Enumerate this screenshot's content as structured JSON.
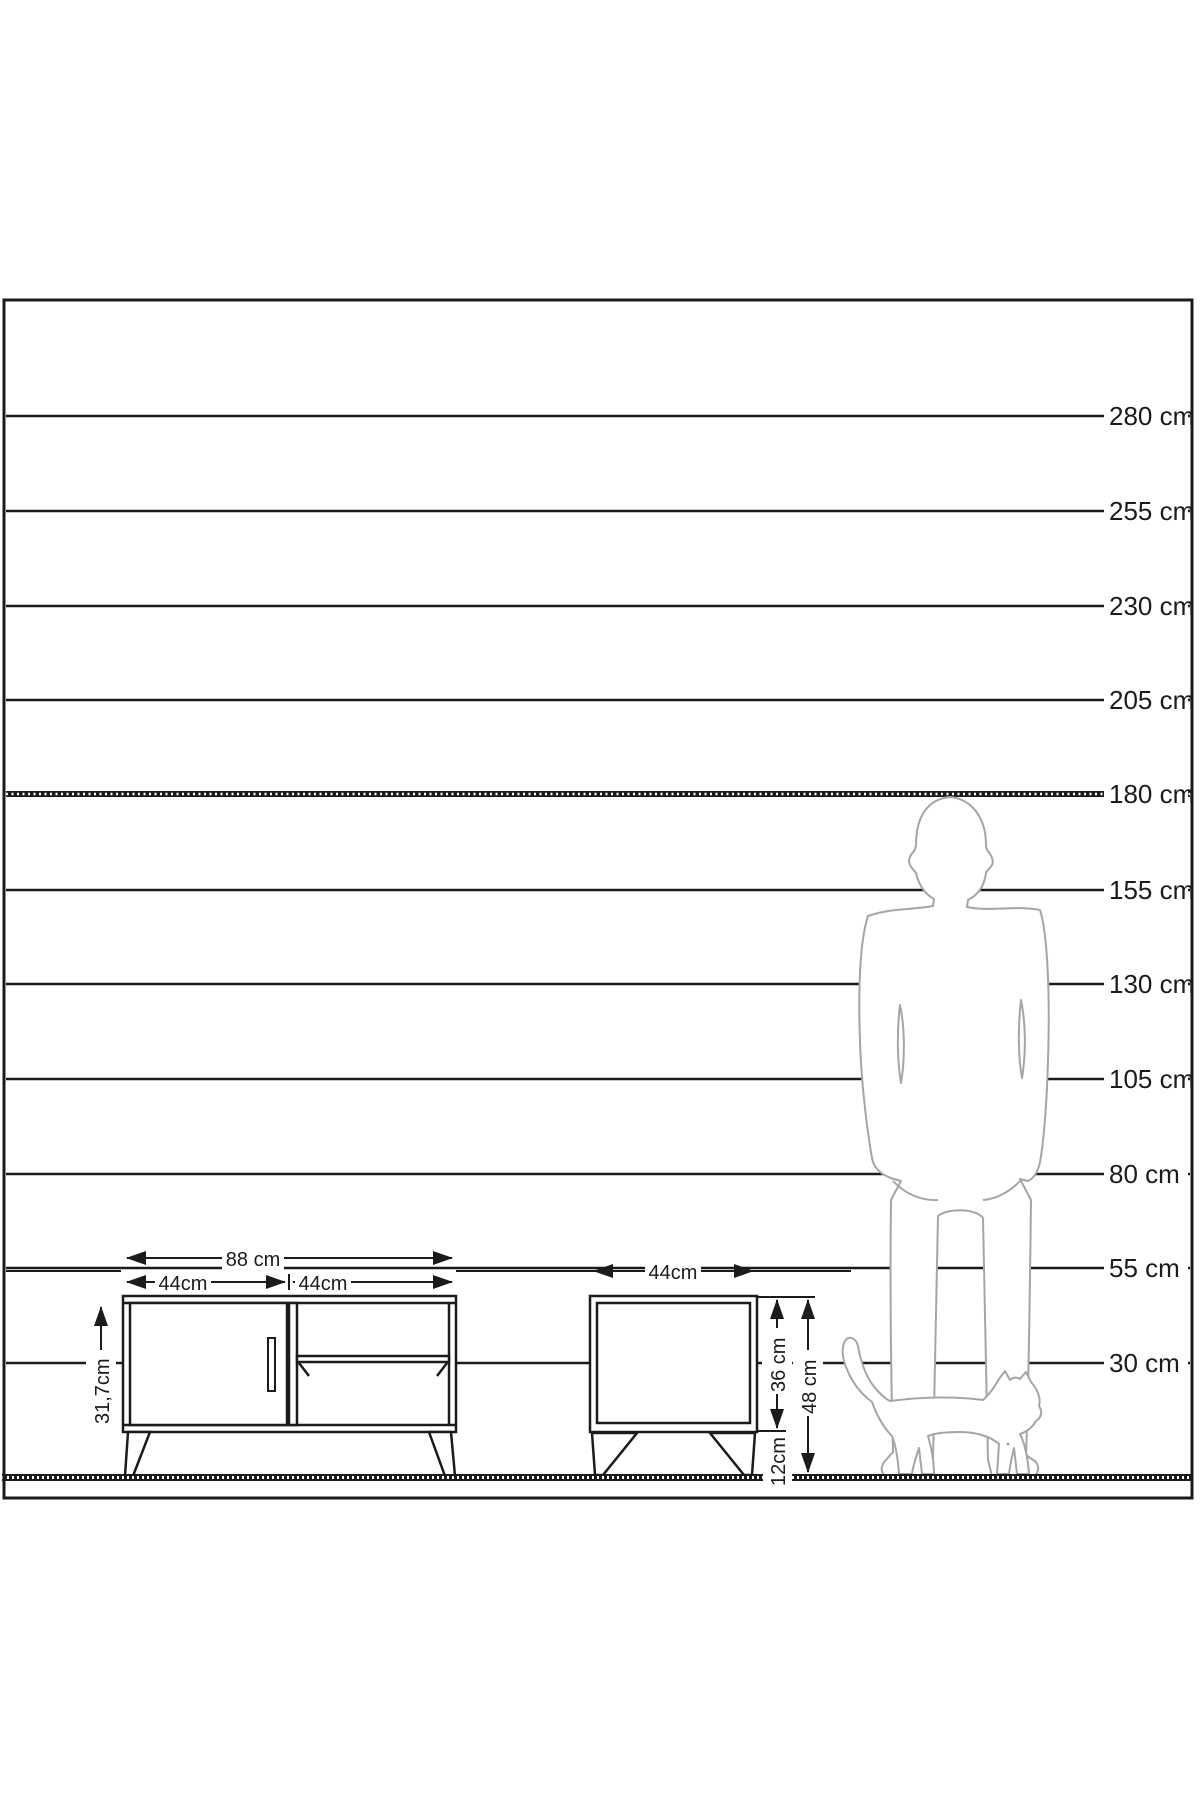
{
  "scale": {
    "labels": [
      "280 cm",
      "255 cm",
      "230 cm",
      "205 cm",
      "180 cm",
      "155 cm",
      "130 cm",
      "105 cm",
      "80 cm",
      "55 cm",
      "30 cm"
    ]
  },
  "tv_stand": {
    "total_width": "88 cm",
    "door_width": "44cm",
    "shelf_width": "44cm",
    "interior_height": "31,7cm"
  },
  "nightstand": {
    "width": "44cm",
    "body_height": "36 cm",
    "leg_height": "12cm",
    "total_height": "48 cm"
  },
  "colors": {
    "line": "#1b1b1b",
    "figure_outline": "#a5a5a5",
    "background": "#ffffff"
  }
}
